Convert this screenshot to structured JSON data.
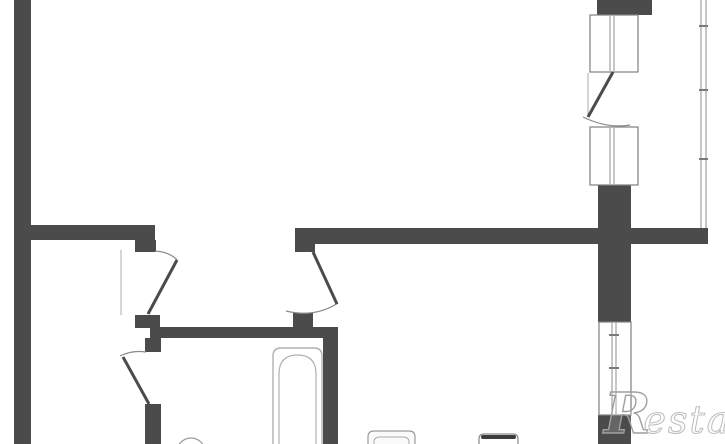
{
  "watermark": {
    "brand_initial": "R",
    "brand_text": "estate"
  },
  "colors": {
    "background": "#ffffff",
    "wall": "#4b4b4b",
    "frame_outline": "#7f7f7f",
    "sash_line": "#8f8f8f",
    "swing_arc": "#8a8a8a",
    "glazing": "#a0a0a0",
    "fixture_line": "#b0b0b0",
    "watermark_initial": "#9f9f9f",
    "watermark_text": "#c0c0c0"
  },
  "floorplan": {
    "canvas": {
      "width": 725,
      "height": 444
    },
    "shapes": [
      {
        "name": "outer-wall-left",
        "type": "rect",
        "attrs": {
          "x": 14,
          "y": 0,
          "width": 17,
          "height": 444,
          "fill": "#4b4b4b"
        }
      },
      {
        "name": "living-room-bottom-wall",
        "type": "rect",
        "attrs": {
          "x": 31,
          "y": 225,
          "width": 124,
          "height": 15,
          "fill": "#4b4b4b"
        }
      },
      {
        "name": "hall-door-jamb-top",
        "type": "rect",
        "attrs": {
          "x": 135,
          "y": 240,
          "width": 21,
          "height": 12,
          "fill": "#4b4b4b"
        }
      },
      {
        "name": "hall-door-jamb-bottom",
        "type": "rect",
        "attrs": {
          "x": 135,
          "y": 315,
          "width": 25,
          "height": 13,
          "fill": "#4b4b4b"
        }
      },
      {
        "name": "kitchen-top-wall",
        "type": "rect",
        "attrs": {
          "x": 295,
          "y": 228,
          "width": 413,
          "height": 16,
          "fill": "#4b4b4b"
        }
      },
      {
        "name": "kitchen-door-jamb-top",
        "type": "rect",
        "attrs": {
          "x": 295,
          "y": 240,
          "width": 20,
          "height": 12,
          "fill": "#4b4b4b"
        }
      },
      {
        "name": "kitchen-door-jamb-bottom",
        "type": "rect",
        "attrs": {
          "x": 293,
          "y": 313,
          "width": 20,
          "height": 15,
          "fill": "#4b4b4b"
        }
      },
      {
        "name": "bathroom-top-wall",
        "type": "rect",
        "attrs": {
          "x": 150,
          "y": 327,
          "width": 188,
          "height": 11,
          "fill": "#4b4b4b"
        }
      },
      {
        "name": "bathroom-left-wall-upper",
        "type": "rect",
        "attrs": {
          "x": 145,
          "y": 338,
          "width": 16,
          "height": 14,
          "fill": "#4b4b4b"
        }
      },
      {
        "name": "bathroom-left-wall-lower",
        "type": "rect",
        "attrs": {
          "x": 145,
          "y": 404,
          "width": 16,
          "height": 40,
          "fill": "#4b4b4b"
        }
      },
      {
        "name": "bathroom-right-wall",
        "type": "rect",
        "attrs": {
          "x": 323,
          "y": 337,
          "width": 15,
          "height": 107,
          "fill": "#4b4b4b"
        }
      },
      {
        "name": "right-wall-top-stub",
        "type": "rect",
        "attrs": {
          "x": 597,
          "y": 0,
          "width": 55,
          "height": 15,
          "fill": "#4b4b4b"
        }
      },
      {
        "name": "right-wall-mid",
        "type": "rect",
        "attrs": {
          "x": 598,
          "y": 185,
          "width": 33,
          "height": 137,
          "fill": "#4b4b4b"
        }
      },
      {
        "name": "right-wall-bottom",
        "type": "rect",
        "attrs": {
          "x": 598,
          "y": 415,
          "width": 33,
          "height": 29,
          "fill": "#4b4b4b"
        }
      },
      {
        "name": "balcony-door-frame",
        "type": "rect",
        "attrs": {
          "x": 590,
          "y": 15,
          "width": 48,
          "height": 57,
          "fill": "#ffffff",
          "stroke": "#7f7f7f",
          "stroke-width": 1.2
        }
      },
      {
        "name": "balcony-door-sash-left",
        "type": "line",
        "attrs": {
          "x1": 610,
          "y1": 16,
          "x2": 610,
          "y2": 71,
          "stroke": "#8f8f8f",
          "stroke-width": 1
        }
      },
      {
        "name": "balcony-door-sash-right",
        "type": "line",
        "attrs": {
          "x1": 614,
          "y1": 16,
          "x2": 614,
          "y2": 71,
          "stroke": "#8f8f8f",
          "stroke-width": 1
        }
      },
      {
        "name": "balcony-window-frame",
        "type": "rect",
        "attrs": {
          "x": 590,
          "y": 127,
          "width": 48,
          "height": 58,
          "fill": "#ffffff",
          "stroke": "#7f7f7f",
          "stroke-width": 1.2
        }
      },
      {
        "name": "balcony-window-sash-left",
        "type": "line",
        "attrs": {
          "x1": 610,
          "y1": 128,
          "x2": 610,
          "y2": 184,
          "stroke": "#8f8f8f",
          "stroke-width": 1
        }
      },
      {
        "name": "balcony-window-sash-right",
        "type": "line",
        "attrs": {
          "x1": 614,
          "y1": 128,
          "x2": 614,
          "y2": 184,
          "stroke": "#8f8f8f",
          "stroke-width": 1
        }
      },
      {
        "name": "kitchen-window-frame",
        "type": "rect",
        "attrs": {
          "x": 599,
          "y": 322,
          "width": 32,
          "height": 93,
          "fill": "#ffffff",
          "stroke": "#7f7f7f",
          "stroke-width": 1.2
        }
      },
      {
        "name": "kitchen-window-sash-left",
        "type": "line",
        "attrs": {
          "x1": 612,
          "y1": 323,
          "x2": 612,
          "y2": 414,
          "stroke": "#8f8f8f",
          "stroke-width": 1
        }
      },
      {
        "name": "kitchen-window-sash-right",
        "type": "line",
        "attrs": {
          "x1": 616,
          "y1": 323,
          "x2": 616,
          "y2": 414,
          "stroke": "#8f8f8f",
          "stroke-width": 1
        }
      },
      {
        "name": "kitchen-window-tick-top",
        "type": "line",
        "attrs": {
          "x1": 609,
          "y1": 335,
          "x2": 619,
          "y2": 335,
          "stroke": "#7a7a7a",
          "stroke-width": 2
        }
      },
      {
        "name": "kitchen-window-tick-bottom",
        "type": "line",
        "attrs": {
          "x1": 609,
          "y1": 368,
          "x2": 619,
          "y2": 368,
          "stroke": "#7a7a7a",
          "stroke-width": 2
        }
      },
      {
        "name": "balcony-glazing-line-inner",
        "type": "line",
        "attrs": {
          "x1": 701,
          "y1": 0,
          "x2": 701,
          "y2": 228,
          "stroke": "#a0a0a0",
          "stroke-width": 1.2
        }
      },
      {
        "name": "balcony-glazing-line-outer",
        "type": "line",
        "attrs": {
          "x1": 706,
          "y1": 0,
          "x2": 706,
          "y2": 228,
          "stroke": "#a0a0a0",
          "stroke-width": 1.2
        }
      },
      {
        "name": "balcony-glazing-tick-1",
        "type": "line",
        "attrs": {
          "x1": 699,
          "y1": 26,
          "x2": 708,
          "y2": 26,
          "stroke": "#7a7a7a",
          "stroke-width": 2
        }
      },
      {
        "name": "balcony-glazing-tick-2",
        "type": "line",
        "attrs": {
          "x1": 699,
          "y1": 90,
          "x2": 708,
          "y2": 90,
          "stroke": "#7a7a7a",
          "stroke-width": 2
        }
      },
      {
        "name": "balcony-glazing-tick-3",
        "type": "line",
        "attrs": {
          "x1": 699,
          "y1": 159,
          "x2": 708,
          "y2": 159,
          "stroke": "#7a7a7a",
          "stroke-width": 2
        }
      },
      {
        "name": "balcony-door-open-line",
        "type": "line",
        "attrs": {
          "x1": 588,
          "y1": 73,
          "x2": 588,
          "y2": 116,
          "stroke": "#ababab",
          "stroke-width": 1
        }
      },
      {
        "name": "hall-door-open-line",
        "type": "line",
        "attrs": {
          "x1": 121,
          "y1": 250,
          "x2": 121,
          "y2": 315,
          "stroke": "#ababab",
          "stroke-width": 1
        }
      },
      {
        "name": "balcony-door-swing-arc",
        "type": "path",
        "attrs": {
          "d": "M 583 117 Q 608 129 630 125",
          "stroke": "#8a8a8a",
          "stroke-width": 1.2,
          "fill": "none"
        }
      },
      {
        "name": "hall-door-swing-arc",
        "type": "path",
        "attrs": {
          "d": "M 155 251 Q 170 252 177 260",
          "stroke": "#8a8a8a",
          "stroke-width": 1.2,
          "fill": "none"
        }
      },
      {
        "name": "kitchen-door-swing-arc",
        "type": "path",
        "attrs": {
          "d": "M 286 311 Q 315 318 338 303",
          "stroke": "#8a8a8a",
          "stroke-width": 1.2,
          "fill": "none"
        }
      },
      {
        "name": "bathroom-door-swing-arc",
        "type": "path",
        "attrs": {
          "d": "M 120 356 Q 132 350 146 352",
          "stroke": "#8a8a8a",
          "stroke-width": 1.2,
          "fill": "none"
        }
      },
      {
        "name": "balcony-door-leaf",
        "type": "line",
        "attrs": {
          "x1": 613,
          "y1": 72,
          "x2": 588,
          "y2": 117,
          "stroke": "#4b4b4b",
          "stroke-width": 3
        }
      },
      {
        "name": "hall-door-leaf",
        "type": "line",
        "attrs": {
          "x1": 177,
          "y1": 260,
          "x2": 148,
          "y2": 314,
          "stroke": "#4b4b4b",
          "stroke-width": 3
        }
      },
      {
        "name": "kitchen-door-leaf",
        "type": "line",
        "attrs": {
          "x1": 313,
          "y1": 252,
          "x2": 337,
          "y2": 304,
          "stroke": "#4b4b4b",
          "stroke-width": 3
        }
      },
      {
        "name": "bathroom-door-leaf",
        "type": "line",
        "attrs": {
          "x1": 149,
          "y1": 404,
          "x2": 123,
          "y2": 357,
          "stroke": "#4b4b4b",
          "stroke-width": 3
        }
      },
      {
        "name": "bathtub-outline",
        "type": "path",
        "attrs": {
          "d": "M 273 444 L 273 356 Q 273 348 281 348 L 314 348 Q 322 348 322 356 L 322 444",
          "stroke": "#b0b0b0",
          "stroke-width": 1.4,
          "fill": "#ffffff"
        }
      },
      {
        "name": "bathtub-basin-line",
        "type": "path",
        "attrs": {
          "d": "M 279 444 L 279 374 Q 279 355 297.5 355 Q 316 355 316 374 L 316 444",
          "stroke": "#b0b0b0",
          "stroke-width": 1.2,
          "fill": "none"
        }
      },
      {
        "name": "washbasin",
        "type": "circle",
        "attrs": {
          "cx": 191,
          "cy": 452,
          "r": 14,
          "stroke": "#9a9a9a",
          "stroke-width": 1.2,
          "fill": "#ffffff"
        }
      },
      {
        "name": "kitchen-sink-outline",
        "type": "path",
        "attrs": {
          "d": "M 368 444 L 368 437 Q 368 431 374 431 L 409 431 Q 415 431 415 437 L 415 444",
          "stroke": "#9a9a9a",
          "stroke-width": 1.2,
          "fill": "#fafafa"
        }
      },
      {
        "name": "kitchen-sink-inner-line",
        "type": "path",
        "attrs": {
          "d": "M 374 444 L 374 442 Q 374 437 380 437 L 403 437 Q 409 437 409 442 L 409 444",
          "stroke": "#ababab",
          "stroke-width": 1,
          "fill": "none"
        }
      },
      {
        "name": "stove-outline",
        "type": "path",
        "attrs": {
          "d": "M 479 444 L 479 439 Q 479 434 484 434 L 513 434 Q 518 434 518 439 L 518 444",
          "stroke": "#8a8a8a",
          "stroke-width": 1.2,
          "fill": "#ffffff"
        }
      },
      {
        "name": "stove-top-band",
        "type": "rect",
        "attrs": {
          "x": 481,
          "y": 435,
          "width": 35,
          "height": 4,
          "rx": 2,
          "fill": "#3c3c3c"
        }
      }
    ]
  }
}
